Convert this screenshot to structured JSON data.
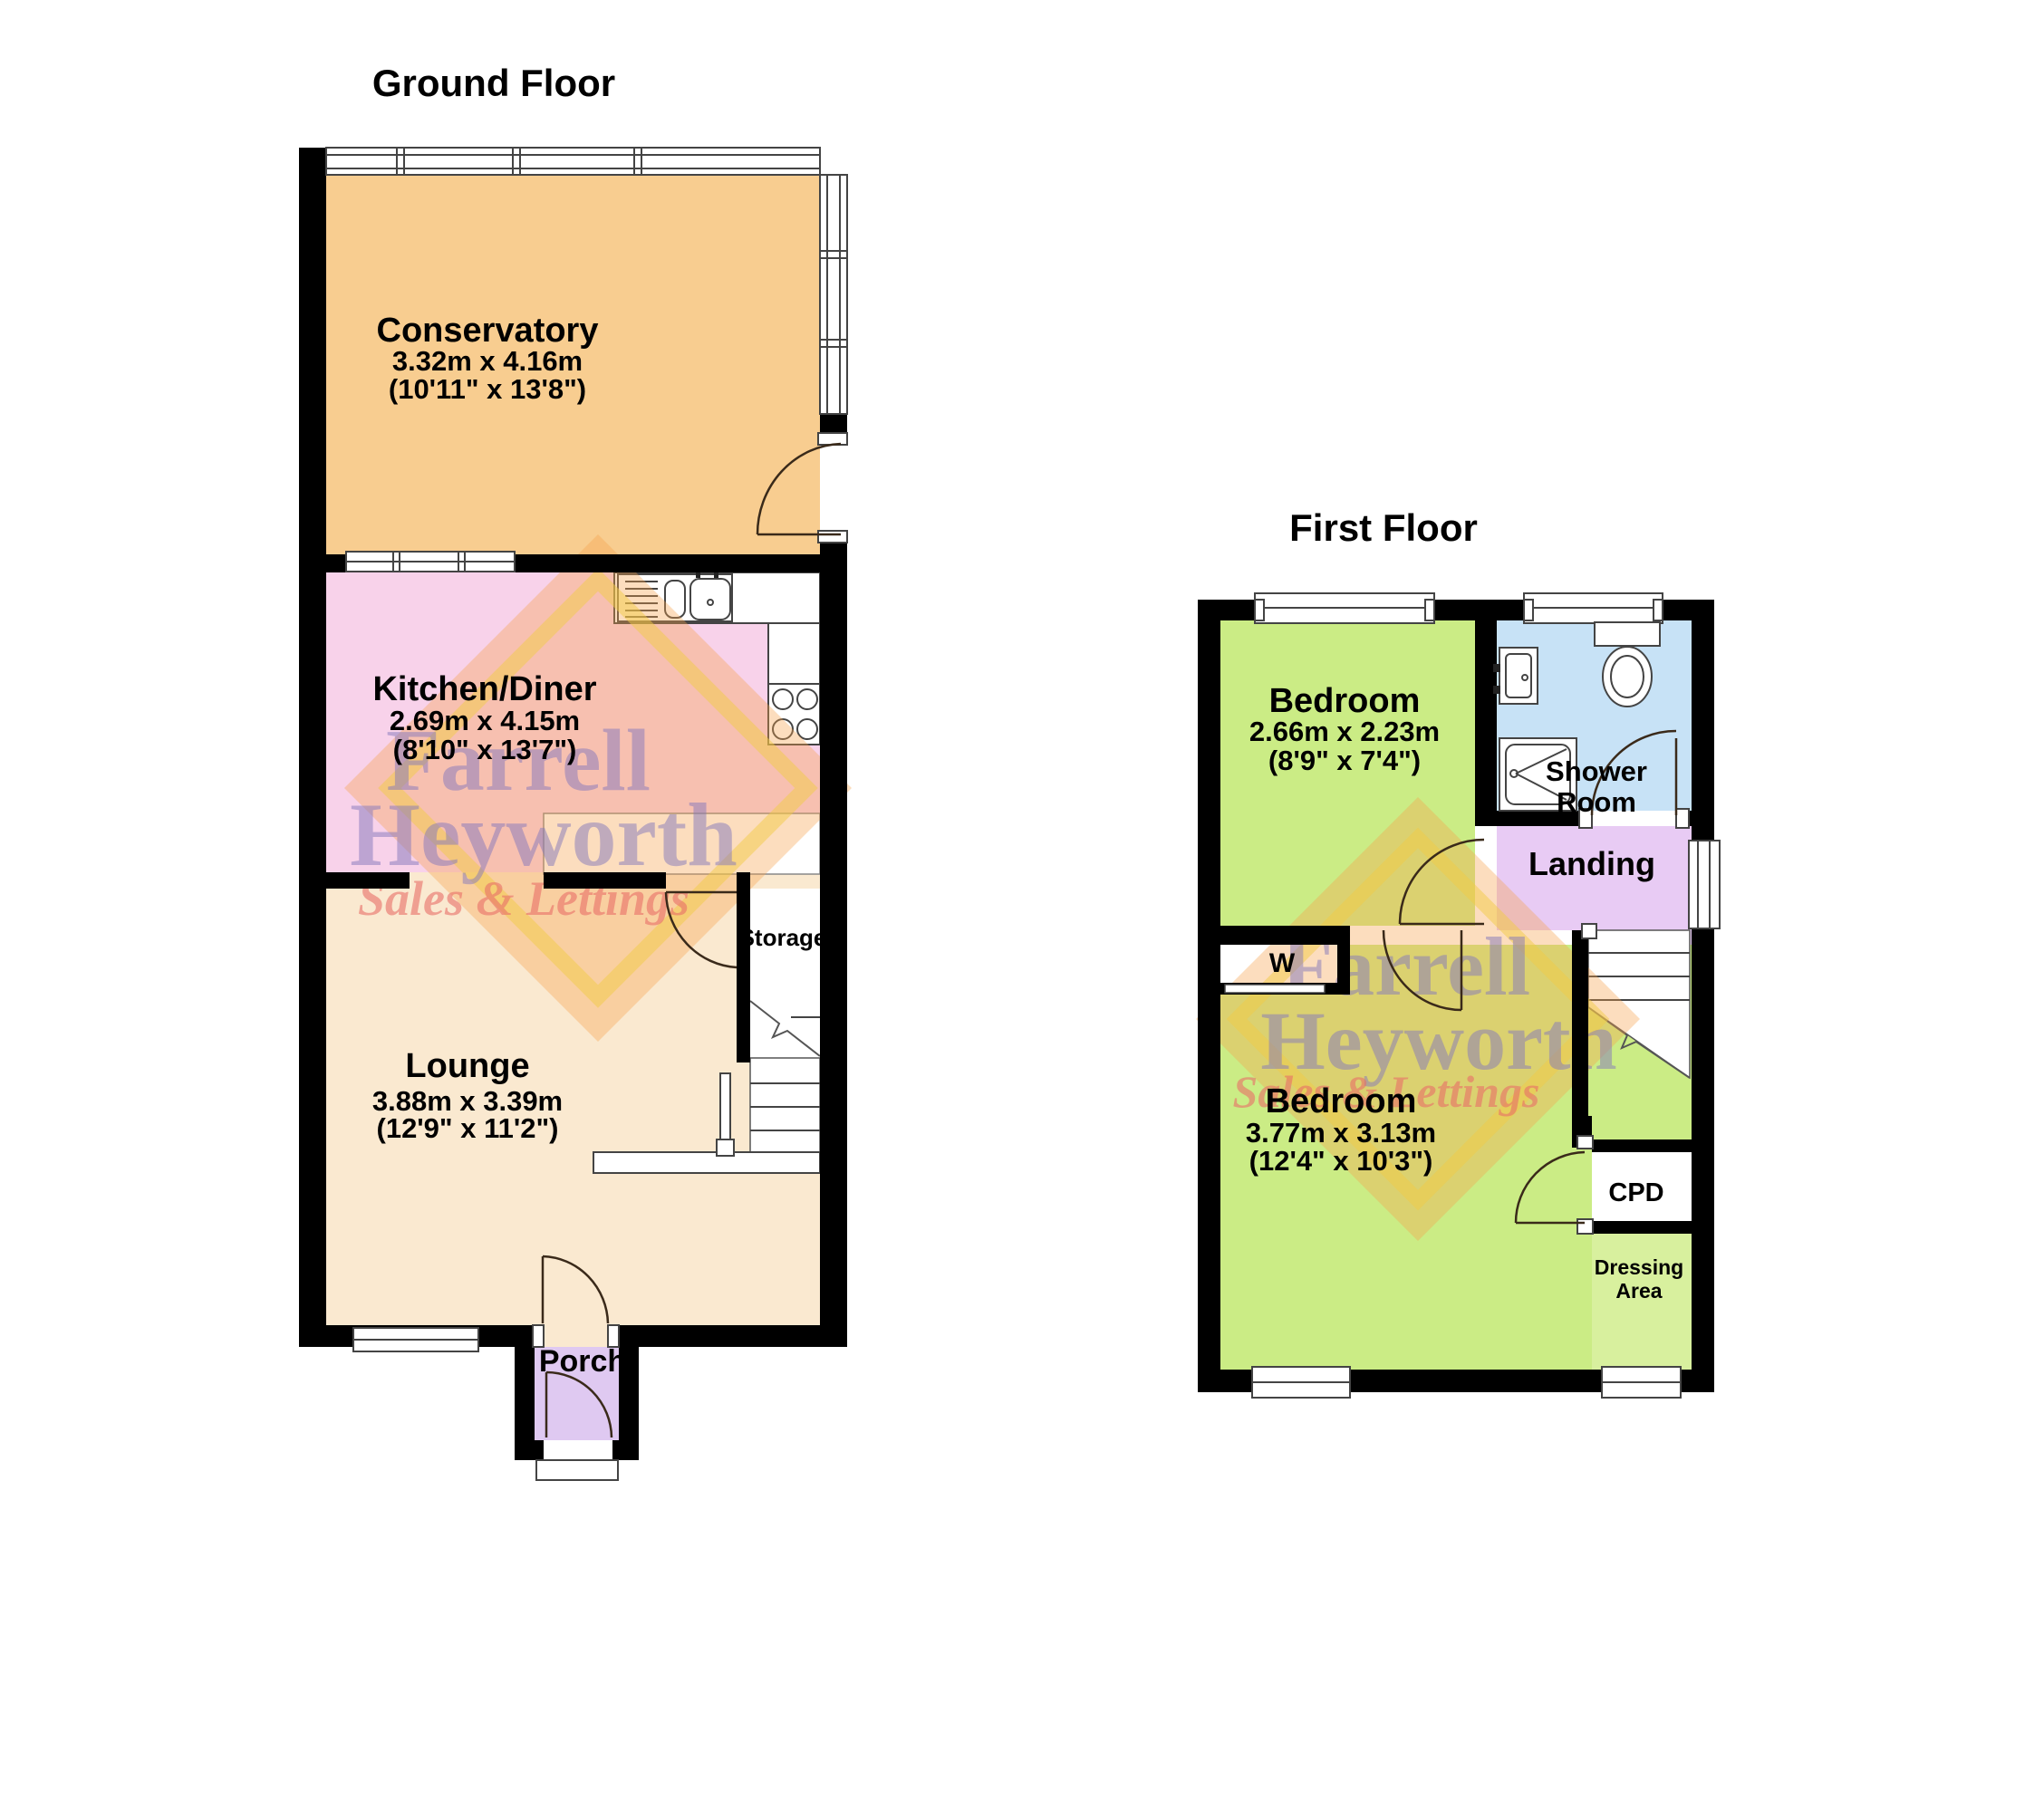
{
  "ground": {
    "title": "Ground Floor",
    "conservatory": {
      "name": "Conservatory",
      "metric": "3.32m x 4.16m",
      "imperial": "(10'11\" x 13'8\")"
    },
    "kitchen": {
      "name": "Kitchen/Diner",
      "metric": "2.69m x 4.15m",
      "imperial": "(8'10\" x 13'7\")"
    },
    "lounge": {
      "name": "Lounge",
      "metric": "3.88m x 3.39m",
      "imperial": "(12'9\" x 11'2\")"
    },
    "storage_label": "Storage",
    "porch_label": "Porch"
  },
  "first": {
    "title": "First Floor",
    "bedroom1": {
      "name": "Bedroom",
      "metric": "2.66m x 2.23m",
      "imperial": "(8'9\" x 7'4\")"
    },
    "shower": {
      "line1": "Shower",
      "line2": "Room"
    },
    "landing_label": "Landing",
    "wardrobe_label": "W",
    "bedroom2": {
      "name": "Bedroom",
      "metric": "3.77m x 3.13m",
      "imperial": "(12'4\" x 10'3\")"
    },
    "cpd_label": "CPD",
    "dressing": {
      "line1": "Dressing",
      "line2": "Area"
    }
  },
  "watermark": {
    "line1": "Farrell",
    "line2": "Heyworth",
    "tagline": "Sales & Lettings"
  },
  "colors": {
    "conservatory": "#F8CD90",
    "kitchen": "#F8D2EA",
    "lounge": "#FAE9D0",
    "porch": "#DFC9F1",
    "bedroom": "#CBEC85",
    "shower": "#C7E2F6",
    "landing": "#E8CBF4",
    "dressing": "#D8F09E",
    "wall": "#000000",
    "wm_name": "#8478BC",
    "wm_tagline": "#E96F68",
    "wm_diamond_fill": "#F6A14C",
    "wm_diamond_edge": "#F2CC45"
  }
}
